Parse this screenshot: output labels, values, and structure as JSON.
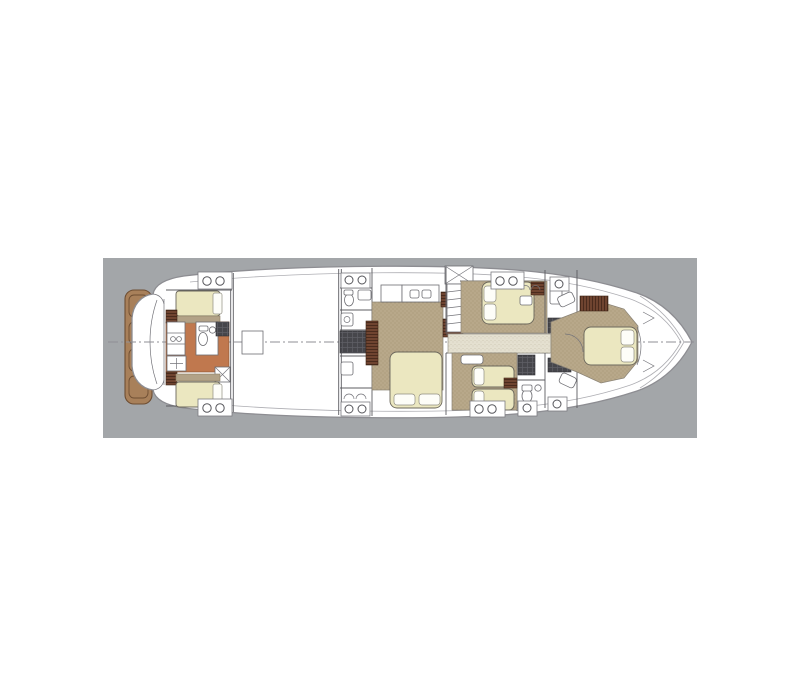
{
  "page": {
    "background": "#ffffff"
  },
  "panel": {
    "background": "#a3a6a9"
  },
  "diagram": {
    "type": "yacht-floor-plan",
    "view": "top-down lower-deck accommodation plan",
    "orientation": "bow pointing right, stern (swim platform) at left",
    "sections": [
      {
        "id": "swim-platform",
        "label": "teak swim platform with four plank steps"
      },
      {
        "id": "crew-cabin",
        "label": "aft crew cabin with two single berths, head and shower"
      },
      {
        "id": "engine-room",
        "label": "blank engine-room bay with central access hatch"
      },
      {
        "id": "aft-bathroom-block",
        "label": "port-side bathroom block with shower and twin vanity"
      },
      {
        "id": "master-stateroom",
        "label": "full-beam master stateroom with double bed and wardrobes"
      },
      {
        "id": "companionway-stairs",
        "label": "staircase up to main deck"
      },
      {
        "id": "guest-cabin-double",
        "label": "forward guest double cabin"
      },
      {
        "id": "guest-cabin-twin",
        "label": "guest twin cabin with two single beds"
      },
      {
        "id": "central-corridor",
        "label": "speckled corridor runner between cabins"
      },
      {
        "id": "forward-bathrooms",
        "label": "forward bathrooms with dark shower cubicles"
      },
      {
        "id": "vip-bow-cabin",
        "label": "VIP bow cabin with island double bed and seats"
      }
    ],
    "counts": {
      "double_beds": 3,
      "single_beds": 4,
      "portholes_top_edge": 7,
      "portholes_bottom_edge": 8,
      "dark_tile_blocks": 7,
      "teak_planks": 4
    }
  },
  "colors": {
    "page_bg": "#ffffff",
    "panel_bg": "#a3a6a9",
    "hull": "#ffffff",
    "outline": "#8d8d92",
    "wall": "#5c5c61",
    "carpet": "#b8a88a",
    "carpet_dot": "#a08f6d",
    "corridor_fill": "#e4e0d0",
    "corridor_dot": "#c9c3ae",
    "bed": "#ebe7c0",
    "bed_stroke": "#6b675c",
    "pillow": "#fdfdf8",
    "crew_floor": "#c0784e",
    "teak": "#a8805a",
    "teak_stroke": "#6e4e33",
    "cabinet_brown": "#6f4430",
    "cabinet_stripe": "#46281a",
    "dark_tile": "#46464b",
    "dark_tile_line": "#5f5f66",
    "headboard": "#b2a287",
    "centerline": "#8f8f95"
  }
}
